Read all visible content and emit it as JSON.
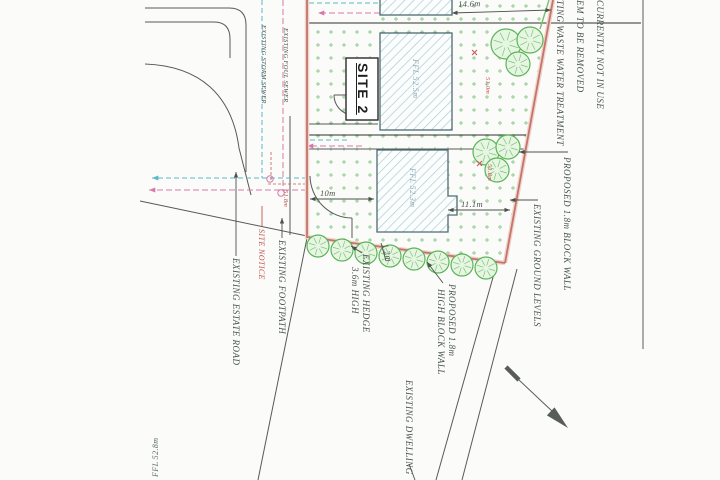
{
  "plan": {
    "site_label": "SITE 2",
    "note_top_right": {
      "line1": "TING WASTE WATER TREATMENT",
      "line2": "EM TO BE REMOVED",
      "line3": "CURRENTLY NOT IN USE"
    },
    "sewers": {
      "storm": "EXISTING STORM SEWER",
      "foul": "EXISTING FOUL SEWER"
    },
    "roads": {
      "estate_road": "EXISTING ESTATE ROAD",
      "footpath": "EXISTING FOOTPATH"
    },
    "site_notice": "SITE NOTICE",
    "hedge": {
      "line1": "EXISTING HEDGE",
      "line2": "3.6m HIGH"
    },
    "walls": {
      "south_line1": "PROPOSED 1.8m",
      "south_line2": "HIGH BLOCK WALL",
      "east": "PROPOSED 1.8m BLOCK WALL"
    },
    "ground_levels": "EXISTING GROUND LEVELS",
    "dwelling": "EXISTING DWELLING",
    "floor_levels": {
      "house_north": "FFL 52.5m",
      "house_south": "FFL 52.3m",
      "existing_sw": "FFL 52.8m"
    },
    "dimensions": {
      "frontage_north": "14.6m",
      "entrance_width": "10m",
      "side_garden": "11.1m",
      "hedge_offset": "1.2m"
    },
    "spot_levels": {
      "entrance": "51.8m",
      "garden_north": "51.0m",
      "garden_south": "51.8m"
    }
  },
  "colors": {
    "boundary_red": "#c4756b",
    "grass_green": "#8cca8c",
    "tree_green": "#5bb457",
    "storm_cyan": "#58b8c8",
    "foul_magenta": "#d878aa",
    "building_hatch": "#a9cdd7",
    "ink": "#4b524c",
    "red_ink": "#c2554e"
  }
}
